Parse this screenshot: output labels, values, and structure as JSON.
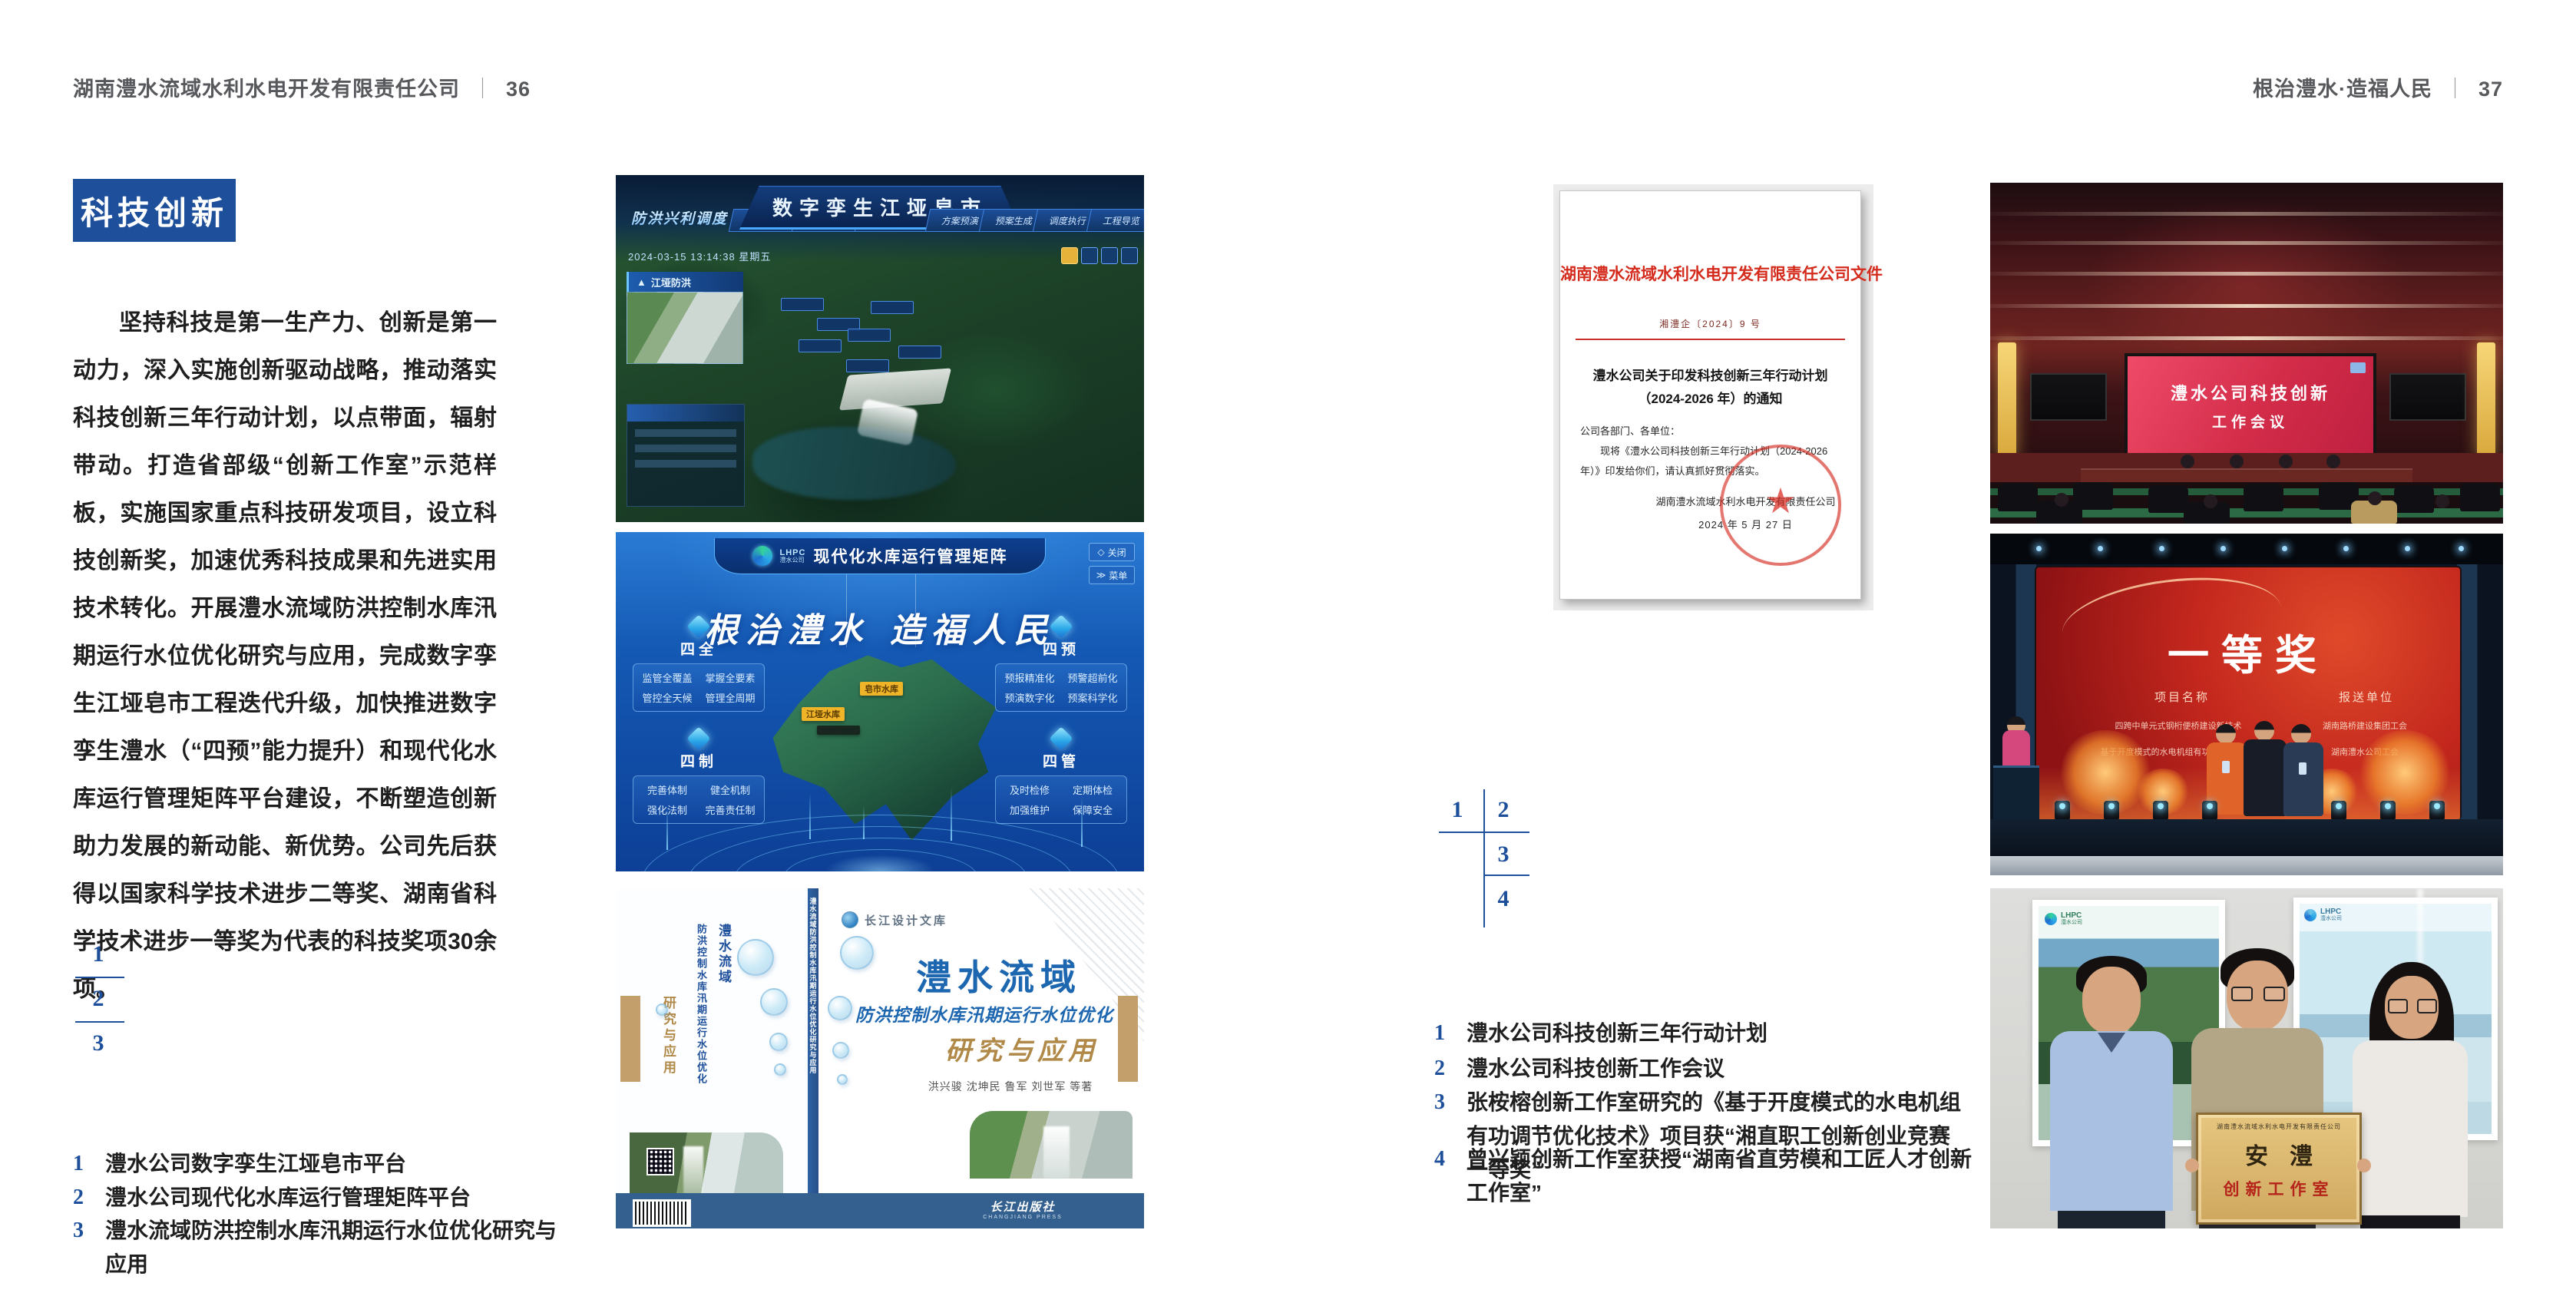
{
  "header_left": {
    "company": "湖南澧水流域水利水电开发有限责任公司",
    "divider": "｜",
    "page": "36"
  },
  "header_right": {
    "slogan": "根治澧水·造福人民",
    "divider": "｜",
    "page": "37"
  },
  "accent_blue": "#1d4f9b",
  "left_page": {
    "badge": "科技创新",
    "paragraph": "坚持科技是第一生产力、创新是第一动力，深入实施创新驱动战略，推动落实科技创新三年行动计划，以点带面，辐射带动。打造省部级“创新工作室”示范样板，实施国家重点科技研发项目，设立科技创新奖，加速优秀科技成果和先进实用技术转化。开展澧水流域防洪控制水库汛期运行水位优化研究与应用，完成数字孪生江垭皂市工程迭代升级，加快推进数字孪生澧水（“四预”能力提升）和现代化水库运行管理矩阵平台建设，不断塑造创新助力发展的新动能、新优势。公司先后获得以国家科学技术进步二等奖、湖南省科学技术进步一等奖为代表的科技奖项30余项。",
    "figure_numbers": [
      "1",
      "2",
      "3"
    ],
    "captions": [
      {
        "num": "1",
        "text": "澧水公司数字孪生江垭皂市平台"
      },
      {
        "num": "2",
        "text": "澧水公司现代化水库运行管理矩阵平台"
      },
      {
        "num": "3",
        "text": "澧水流域防洪控制水库汛期运行水位优化研究与应用"
      }
    ]
  },
  "figure1": {
    "title": "数字孪生江垭皂市",
    "corner_label": "防洪兴利调度",
    "timestamp": "2024-03-15 13:14:38 星期五",
    "nav_left": [
      "实时监测",
      "洪水预报",
      "防洪预警"
    ],
    "nav_right": [
      "方案预演",
      "预案生成",
      "调度执行",
      "工程导览"
    ],
    "panel_title": "江垭防洪"
  },
  "figure2": {
    "logo_line1": "LHPC",
    "logo_line2": "澧水公司",
    "title": "现代化水库运行管理矩阵",
    "slogan": "根治澧水 造福人民",
    "btn_close": "关闭",
    "btn_menu": "菜单",
    "cards": [
      {
        "name": "四全",
        "items": [
          "监管全覆盖",
          "掌握全要素",
          "管控全天候",
          "管理全周期"
        ]
      },
      {
        "name": "四预",
        "items": [
          "预报精准化",
          "预警超前化",
          "预演数字化",
          "预案科学化"
        ]
      },
      {
        "name": "四制",
        "items": [
          "完善体制",
          "健全机制",
          "强化法制",
          "完善责任制"
        ]
      },
      {
        "name": "四管",
        "items": [
          "及时检修",
          "定期体检",
          "加强维护",
          "保障安全"
        ]
      }
    ],
    "map_labels": [
      "皂市水库",
      "江垭水库"
    ]
  },
  "figure3": {
    "series": "长江设计文库",
    "title1": "澧水流域",
    "title2": "防洪控制水库汛期运行水位优化",
    "title3": "研究与应用",
    "authors": "洪兴骏  沈坤民  鲁军  刘世军  等著",
    "publisher": "长江出版社",
    "publisher_en": "CHANGJIANG PRESS",
    "spine_text": "澧水流域防洪控制水库汛期运行水位优化研究与应用"
  },
  "right_page": {
    "document": {
      "header": "湖南澧水流域水利水电开发有限责任公司文件",
      "doc_no": "湘澧企〔2024〕9 号",
      "title1": "澧水公司关于印发科技创新三年行动计划",
      "title2": "（2024-2026 年）的通知",
      "salutation": "公司各部门、各单位：",
      "body": "现将《澧水公司科技创新三年行动计划（2024-2026 年）》印发给你们，请认真抓好贯彻落实。",
      "signer": "湖南澧水流域水利水电开发有限责任公司",
      "date": "2024 年 5 月 27 日",
      "seal_star": "★"
    },
    "figure_numbers": [
      "1",
      "2",
      "3",
      "4"
    ],
    "captions": [
      {
        "num": "1",
        "text": "澧水公司科技创新三年行动计划"
      },
      {
        "num": "2",
        "text": "澧水公司科技创新工作会议"
      },
      {
        "num": "3",
        "text": "张桉榕创新工作室研究的《基于开度模式的水电机组有功调节优化技术》项目获“湘直职工创新创业竞赛一等奖”"
      },
      {
        "num": "4",
        "text": "曾兴颖创新工作室获授“湖南省直劳模和工匠人才创新工作室”"
      }
    ],
    "photo_meeting": {
      "screen_line1": "澧水公司科技创新",
      "screen_line2": "工作会议"
    },
    "photo_award": {
      "title": "一等奖",
      "col1": "项目名称",
      "col2": "报送单位",
      "row1_left": "四跨中单元式钢桁便桥建设新技术",
      "row1_right": "湖南路桥建设集团工会",
      "row2_left": "基于开度模式的水电机组有功调节优化技术",
      "row2_right": "湖南澧水公司工会"
    },
    "photo_group": {
      "plaque_header": "湖南澧水流域水利水电开发有限责任公司",
      "plaque_main": "安澧",
      "plaque_sub": "创新工作室",
      "poster_logo_a": "LHPC",
      "poster_logo_b": "澧水公司"
    }
  }
}
